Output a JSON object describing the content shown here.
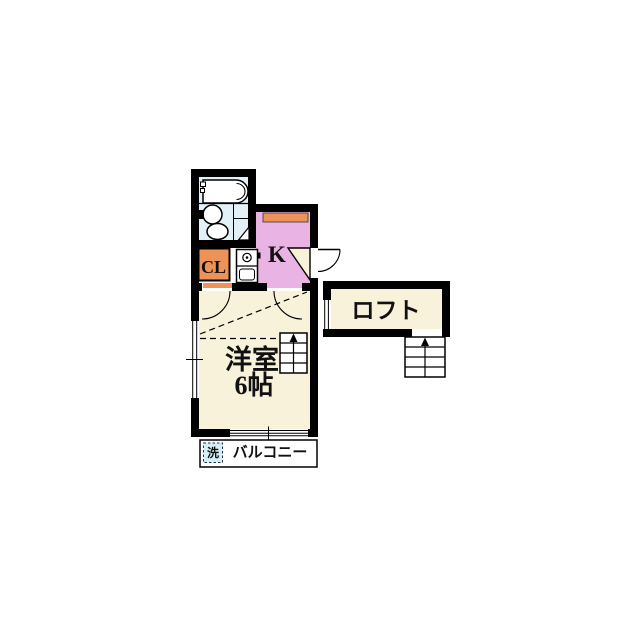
{
  "floorplan": {
    "labels": {
      "main_room_line1": "洋室",
      "main_room_line2": "6帖",
      "kitchen": "K",
      "closet": "CL",
      "loft": "ロフト",
      "balcony": "バルコニー",
      "washer": "洗"
    },
    "colors": {
      "wall": "#000000",
      "bathroom_floor": "#e2f1f8",
      "kitchen_floor": "#e9b4e4",
      "counter_orange": "#ee9357",
      "closet_orange": "#ee9357",
      "room_floor": "#f8f2da",
      "loft_floor": "#f8f2da",
      "door_wedge": "#f8f2da",
      "washer_box": "#d5eef5",
      "kitchen_label_color": "#1b1b35"
    },
    "fixtures": [
      "bathtub",
      "washbasin",
      "toilet",
      "bathroom-folding-door",
      "kitchen-sink",
      "kitchen-counter",
      "entrance-door",
      "ladder-to-loft",
      "stairs-to-loft",
      "washing-machine-space",
      "window-left",
      "window-balcony",
      "window-loft"
    ]
  }
}
